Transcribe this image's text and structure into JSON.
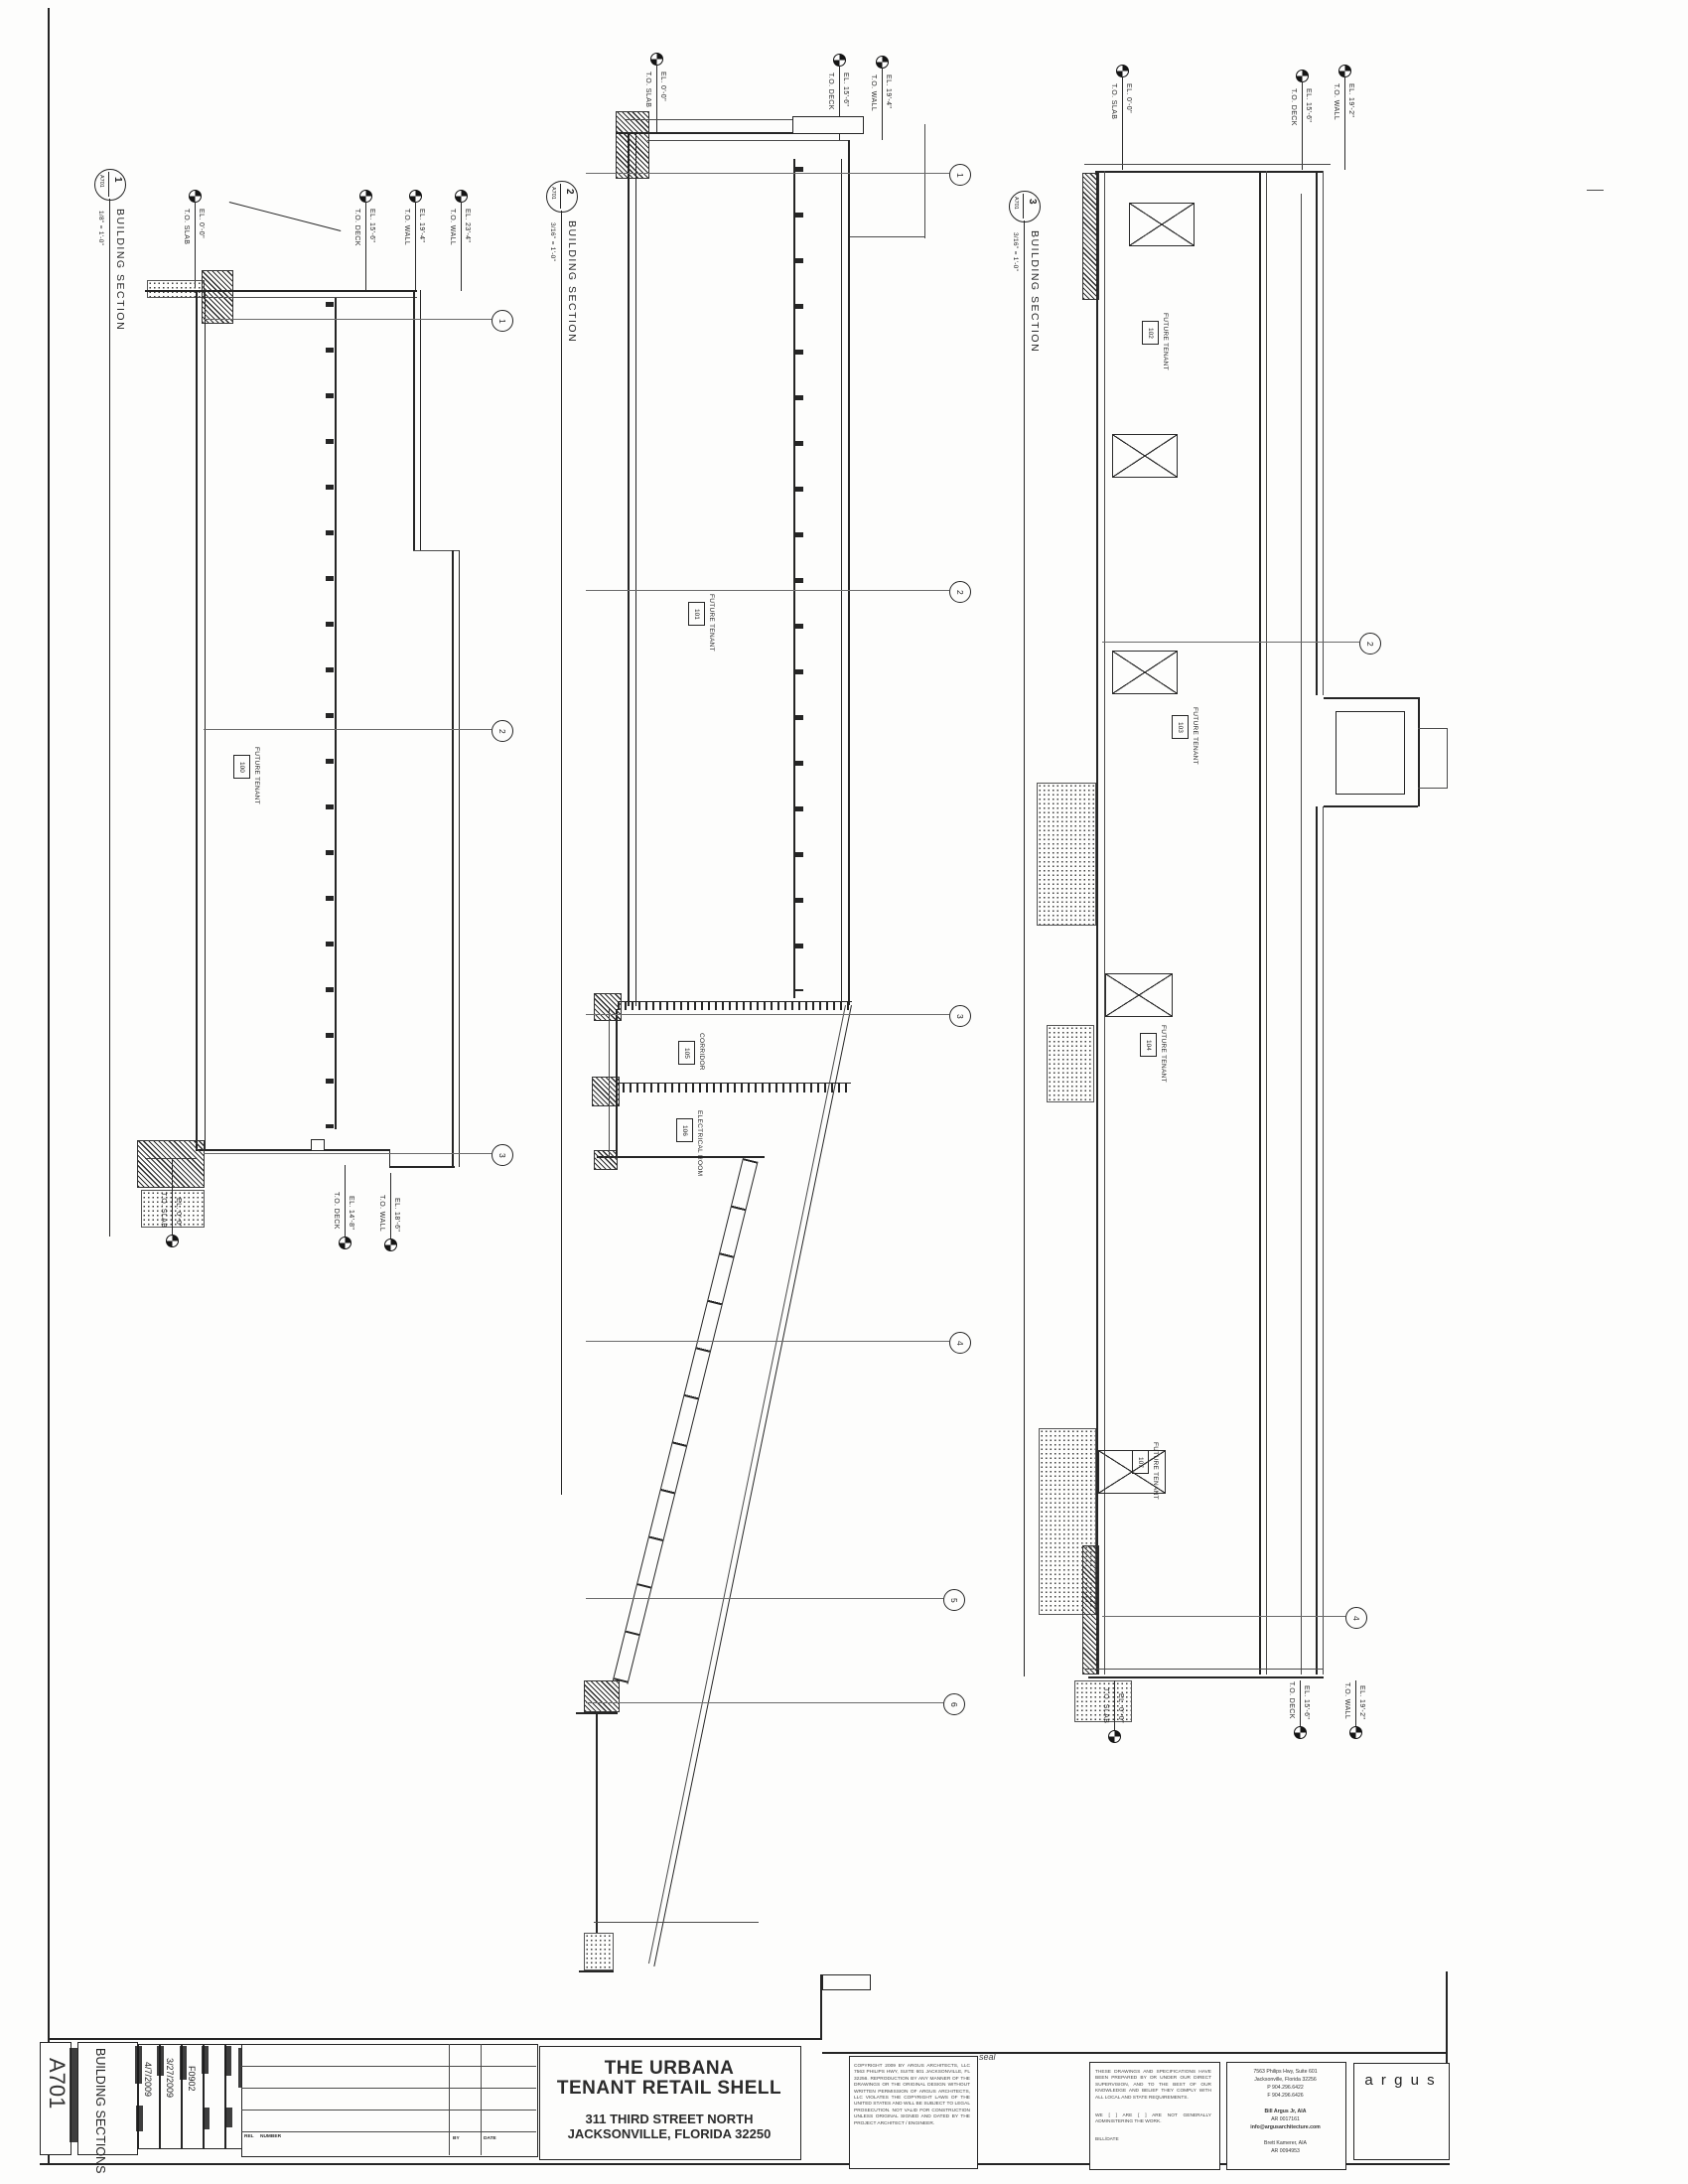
{
  "sheet": {
    "number": "A701",
    "title": "BUILDING SECTIONS",
    "date1": "4/7/2009",
    "date2": "3/27/2009",
    "project_no": "F0902",
    "rev": {
      "rel_label": "REL",
      "number_label": "NUMBER",
      "by_label": "BY",
      "date_label": "DATE"
    }
  },
  "sections": [
    {
      "number": "1",
      "sheet_ref": "A701",
      "title": "BUILDING SECTION",
      "scale": "1/8\" = 1'-0\"",
      "room_tags": [
        {
          "name": "FUTURE TENANT",
          "tag": "100"
        }
      ],
      "markers_top": [
        {
          "el": "EL. 0'-0\"",
          "ref": "T.O. SLAB"
        },
        {
          "el": "EL. 15'-6\"",
          "ref": "T.O. DECK"
        },
        {
          "el": "EL. 19'-4\"",
          "ref": "T.O. WALL"
        },
        {
          "el": "EL. 23'-4\"",
          "ref": "T.O. WALL"
        }
      ],
      "markers_bottom": [
        {
          "el": "EL. 0'-0\"",
          "ref": "T.O. SLAB"
        },
        {
          "el": "EL. 14'-8\"",
          "ref": "T.O. DECK"
        },
        {
          "el": "EL. 18'-6\"",
          "ref": "T.O. WALL"
        }
      ],
      "grids": [
        "1",
        "2",
        "3"
      ]
    },
    {
      "number": "2",
      "sheet_ref": "A701",
      "title": "BUILDING SECTION",
      "scale": "3/16\" = 1'-0\"",
      "room_tags": [
        {
          "name": "FUTURE TENANT",
          "tag": "101"
        },
        {
          "name": "CORRIDOR",
          "tag": "105"
        },
        {
          "name": "ELECTRICAL ROOM",
          "tag": "106"
        }
      ],
      "markers_top": [
        {
          "el": "EL. 0'-0\"",
          "ref": "T.O. SLAB"
        },
        {
          "el": "EL. 15'-6\"",
          "ref": "T.O. DECK"
        },
        {
          "el": "EL. 19'-4\"",
          "ref": "T.O. WALL"
        }
      ],
      "grids": [
        "1",
        "2",
        "3",
        "4",
        "5",
        "6"
      ]
    },
    {
      "number": "3",
      "sheet_ref": "A701",
      "title": "BUILDING SECTION",
      "scale": "3/16\" = 1'-0\"",
      "room_tags": [
        {
          "name": "FUTURE TENANT",
          "tag": "102"
        },
        {
          "name": "FUTURE TENANT",
          "tag": "103"
        },
        {
          "name": "FUTURE TENANT",
          "tag": "104"
        },
        {
          "name": "FUTURE TENANT",
          "tag": "107"
        }
      ],
      "markers_top": [
        {
          "el": "EL. 0'-0\"",
          "ref": "T.O. SLAB"
        },
        {
          "el": "EL. 15'-6\"",
          "ref": "T.O. DECK"
        },
        {
          "el": "EL. 19'-2\"",
          "ref": "T.O. WALL"
        }
      ],
      "markers_bottom": [
        {
          "el": "EL. 0'-0\"",
          "ref": "T.O. SLAB"
        },
        {
          "el": "EL. 15'-6\"",
          "ref": "T.O. DECK"
        },
        {
          "el": "EL. 19'-2\"",
          "ref": "T.O. WALL"
        }
      ],
      "grids": [
        "2",
        "4"
      ]
    }
  ],
  "title_block": {
    "project_name_line1": "THE URBANA",
    "project_name_line2": "TENANT RETAIL SHELL",
    "address_line1": "311 THIRD STREET NORTH",
    "address_line2": "JACKSONVILLE, FLORIDA  32250",
    "seal_label": "seal",
    "copyright_text": "COPYRIGHT 2009 BY ARGUS ARCHITECTS, LLC 7563 PHILIPS HWY, SUITE 601 JACKSONVILLE, FL 32256. REPRODUCTION BY ANY MANNER OF THE DRAWINGS OR THE ORIGINAL DESIGN WITHOUT WRITTEN PERMISSION OF ARGUS ARCHITECTS, LLC VIOLATES THE COPYRIGHT LAWS OF THE UNITED STATES AND WILL BE SUBJECT TO LEGAL PROSECUTION. NOT VALID FOR CONSTRUCTION UNLESS ORIGINAL SIGNED AND DATED BY THE PROJECT ARCHITECT / ENGINEER.",
    "certification_p1": "THESE DRAWINGS AND SPECIFICATIONS HAVE BEEN PREPARED BY OR UNDER OUR DIRECT SUPERVISION, AND TO THE BEST OF OUR KNOWLEDGE AND BELIEF THEY COMPLY WITH ALL LOCAL AND STATE REQUIREMENTS.",
    "certification_p2": "WE [   ] ARE [   ] ARE NOT GENERALLY ADMINISTERING THE WORK.",
    "certification_p3": "BILL/DATE",
    "firm_lines": [
      "7563 Philips Hwy, Suite 601",
      "Jacksonville, Florida  32256",
      "P  904.296.6422",
      "F  904.296.6426",
      "Bill Argus Jr, AIA",
      "AR 0017161",
      "info@argusarchitecture.com",
      "Brett Kamerer, AIA",
      "AR 0094953"
    ],
    "logo_text": "a r g u s"
  }
}
